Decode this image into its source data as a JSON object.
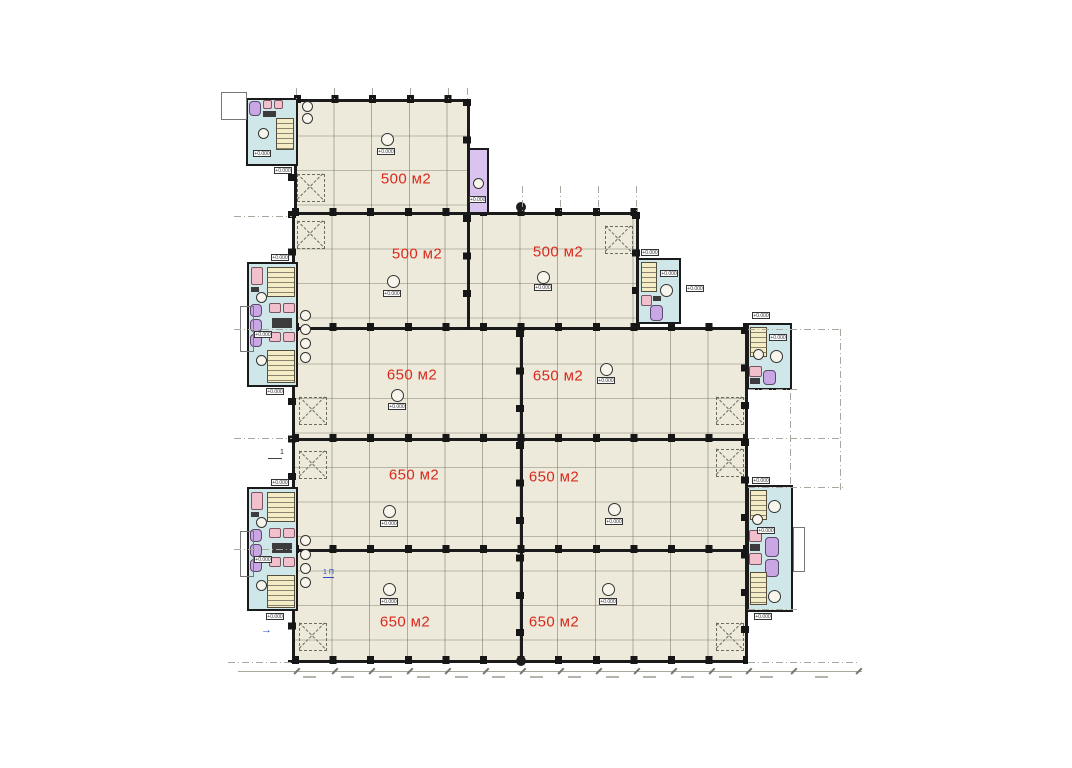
{
  "area_labels": [
    {
      "room": "hall-row1",
      "text": "500 м2"
    },
    {
      "room": "hall-row2-left",
      "text": "500 м2"
    },
    {
      "room": "hall-row2-right",
      "text": "500 м2"
    },
    {
      "room": "hall-row3-left",
      "text": "650 м2"
    },
    {
      "room": "hall-row3-right",
      "text": "650 м2"
    },
    {
      "room": "hall-row4-left",
      "text": "650 м2"
    },
    {
      "room": "hall-row4-right",
      "text": "650 м2"
    },
    {
      "room": "hall-row5-left",
      "text": "650 м2"
    },
    {
      "room": "hall-row5-right",
      "text": "650 м2"
    }
  ],
  "markers": {
    "elevation_text": "+0.000"
  },
  "annotations": {
    "blue_note": "1 П",
    "section_mark": "1"
  },
  "colors": {
    "wall": "#1b1b1b",
    "floor": "#edeadb",
    "core_fill": "#cfe7e9",
    "stair_fill": "#f3ecc4",
    "fixture_purple": "#c9a6e4",
    "fixture_pink": "#f2bfcd",
    "elevator_fill": "#d9c3ef",
    "area_label_red": "#da291c",
    "annotation_blue": "#2b4bd0",
    "dimension_gray": "#a9a89e"
  }
}
